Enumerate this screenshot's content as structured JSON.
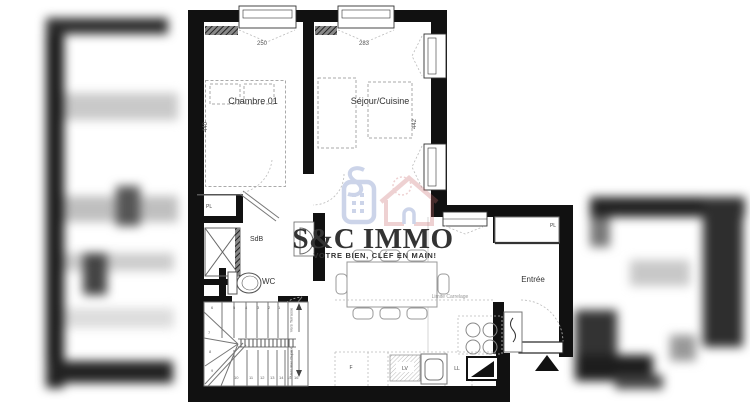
{
  "watermark": {
    "brand": "S&C IMMO",
    "tagline": "VOTRE BIEN, CLÉF EN MAIN!",
    "brand_color": "#1e2b5e",
    "tagline_color": "#cf3a3c"
  },
  "plan": {
    "rooms": {
      "bedroom": "Chambre 01",
      "living": "Séjour/Cuisine",
      "bathroom": "SdB",
      "wc": "WC",
      "entry": "Entrée"
    },
    "closets": {
      "bedroom_pl": "PL",
      "entry_pl": "PL"
    },
    "dimensions": {
      "bedroom_width": "250",
      "living_width": "283",
      "bedroom_depth": "440",
      "living_depth": "442",
      "dining_depth": "366"
    },
    "appliances": {
      "fridge": "F",
      "dishwasher": "LV",
      "washing_machine": "LL"
    },
    "notes": {
      "tile_limit": "Limite Carrelage"
    },
    "stairs": {
      "to_terrace": "Vers Terrasse",
      "to_lower_level": "Vers Bas Duplex",
      "top_run": [
        "6",
        "5",
        "4",
        "3",
        "2",
        "1"
      ],
      "left_run": [
        "7",
        "8",
        "9"
      ],
      "bottom_run": [
        "10",
        "11",
        "12",
        "13",
        "14",
        "15",
        "16"
      ]
    }
  },
  "colors": {
    "wall": "#111111",
    "plan_line": "#8a8a8a"
  }
}
